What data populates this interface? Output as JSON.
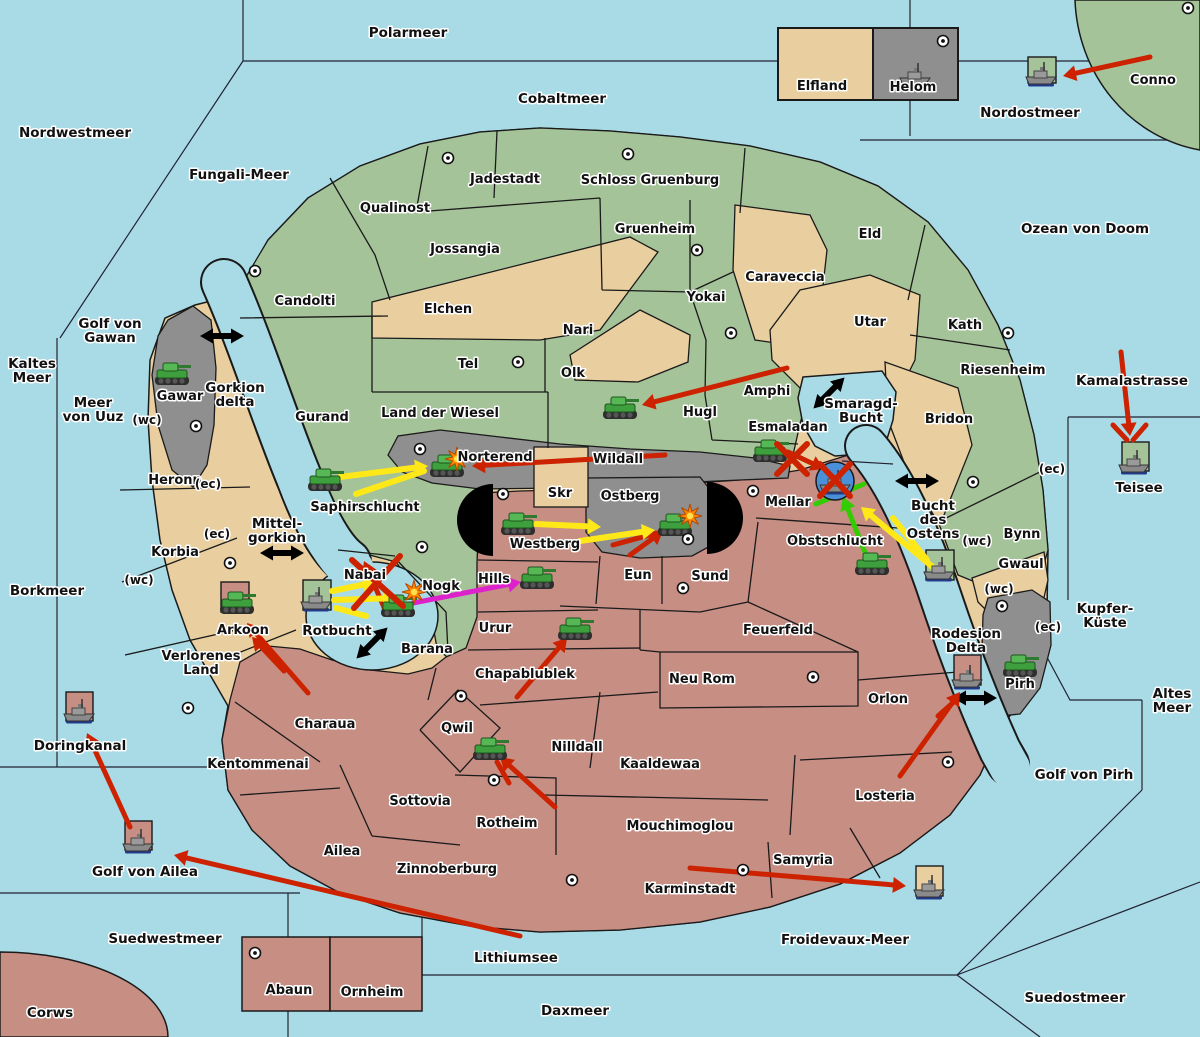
{
  "map_title": "Risk-style war map",
  "colors": {
    "sea": "#a9dbe7",
    "green_land": "#a5c398",
    "tan_land": "#e9cf9f",
    "salmon_land": "#c78e84",
    "gray_land": "#8f8f8f",
    "border": "#1a1a1a",
    "attack_red": "#cc2200",
    "attack_yellow": "#ffe818",
    "attack_green": "#33cc00",
    "attack_magenta": "#dd22cc",
    "naval_circle": "#4a90d9",
    "explosion": "#ff8800"
  },
  "sea_labels": [
    {
      "lines": [
        "Polarmeer"
      ],
      "x": 408,
      "y": 37
    },
    {
      "lines": [
        "Nordwestmeer"
      ],
      "x": 75,
      "y": 137
    },
    {
      "lines": [
        "Fungali-Meer"
      ],
      "x": 239,
      "y": 179
    },
    {
      "lines": [
        "Cobaltmeer"
      ],
      "x": 562,
      "y": 103
    },
    {
      "lines": [
        "Nordostmeer"
      ],
      "x": 1030,
      "y": 117
    },
    {
      "lines": [
        "Ozean von Doom"
      ],
      "x": 1085,
      "y": 233
    },
    {
      "lines": [
        "Kaltes",
        "Meer"
      ],
      "x": 32,
      "y": 368
    },
    {
      "lines": [
        "Golf von",
        "Gawan"
      ],
      "x": 110,
      "y": 328
    },
    {
      "lines": [
        "Meer",
        "von Uuz"
      ],
      "x": 93,
      "y": 407
    },
    {
      "lines": [
        "Gorkion",
        "delta"
      ],
      "x": 235,
      "y": 392
    },
    {
      "lines": [
        "Kamalastrasse"
      ],
      "x": 1132,
      "y": 385
    },
    {
      "lines": [
        "Mittel-",
        "gorkion"
      ],
      "x": 277,
      "y": 528
    },
    {
      "lines": [
        "Borkmeer"
      ],
      "x": 47,
      "y": 595
    },
    {
      "lines": [
        "Smaragd-",
        "Bucht"
      ],
      "x": 861,
      "y": 408
    },
    {
      "lines": [
        "Bucht",
        "des",
        "Ostens"
      ],
      "x": 933,
      "y": 510
    },
    {
      "lines": [
        "Teisee"
      ],
      "x": 1139,
      "y": 492
    },
    {
      "lines": [
        "Rotbucht"
      ],
      "x": 337,
      "y": 635
    },
    {
      "lines": [
        "Kupfer-",
        "Küste"
      ],
      "x": 1105,
      "y": 613
    },
    {
      "lines": [
        "Rodesion",
        "Delta"
      ],
      "x": 966,
      "y": 638
    },
    {
      "lines": [
        "Altes",
        "Meer"
      ],
      "x": 1172,
      "y": 698
    },
    {
      "lines": [
        "Golf von Pirh"
      ],
      "x": 1084,
      "y": 779
    },
    {
      "lines": [
        "Golf von Ailea"
      ],
      "x": 145,
      "y": 876
    },
    {
      "lines": [
        "Doringkanal"
      ],
      "x": 80,
      "y": 750
    },
    {
      "lines": [
        "Suedwestmeer"
      ],
      "x": 165,
      "y": 943
    },
    {
      "lines": [
        "Lithiumsee"
      ],
      "x": 516,
      "y": 962
    },
    {
      "lines": [
        "Daxmeer"
      ],
      "x": 575,
      "y": 1015
    },
    {
      "lines": [
        "Froidevaux-Meer"
      ],
      "x": 845,
      "y": 944
    },
    {
      "lines": [
        "Suedostmeer"
      ],
      "x": 1075,
      "y": 1002
    },
    {
      "lines": [
        "Corws"
      ],
      "x": 50,
      "y": 1017
    }
  ],
  "territory_labels": [
    {
      "lines": [
        "Qualinost"
      ],
      "x": 395,
      "y": 212
    },
    {
      "lines": [
        "Jadestadt"
      ],
      "x": 505,
      "y": 183
    },
    {
      "lines": [
        "Schloss Gruenburg"
      ],
      "x": 650,
      "y": 184
    },
    {
      "lines": [
        "Jossangia"
      ],
      "x": 465,
      "y": 253
    },
    {
      "lines": [
        "Candolti"
      ],
      "x": 305,
      "y": 305
    },
    {
      "lines": [
        "Gruenheim"
      ],
      "x": 655,
      "y": 233
    },
    {
      "lines": [
        "Elchen"
      ],
      "x": 448,
      "y": 313
    },
    {
      "lines": [
        "Nari"
      ],
      "x": 578,
      "y": 334
    },
    {
      "lines": [
        "Olk"
      ],
      "x": 573,
      "y": 377
    },
    {
      "lines": [
        "Tel"
      ],
      "x": 468,
      "y": 368
    },
    {
      "lines": [
        "Gurand"
      ],
      "x": 322,
      "y": 421
    },
    {
      "lines": [
        "Land der Wiesel"
      ],
      "x": 440,
      "y": 417
    },
    {
      "lines": [
        "Yokai"
      ],
      "x": 706,
      "y": 301
    },
    {
      "lines": [
        "Caraveccia"
      ],
      "x": 785,
      "y": 281
    },
    {
      "lines": [
        "Eld"
      ],
      "x": 870,
      "y": 238
    },
    {
      "lines": [
        "Utar"
      ],
      "x": 870,
      "y": 326
    },
    {
      "lines": [
        "Kath"
      ],
      "x": 965,
      "y": 329
    },
    {
      "lines": [
        "Riesenheim"
      ],
      "x": 1003,
      "y": 374
    },
    {
      "lines": [
        "Bridon"
      ],
      "x": 949,
      "y": 423
    },
    {
      "lines": [
        "Amphi"
      ],
      "x": 767,
      "y": 395
    },
    {
      "lines": [
        "Hugl"
      ],
      "x": 700,
      "y": 416
    },
    {
      "lines": [
        "Esmaladan"
      ],
      "x": 788,
      "y": 431
    },
    {
      "lines": [
        "Gawar"
      ],
      "x": 180,
      "y": 400
    },
    {
      "lines": [
        "Heronn"
      ],
      "x": 175,
      "y": 484
    },
    {
      "lines": [
        "Korbia"
      ],
      "x": 175,
      "y": 556
    },
    {
      "lines": [
        "Saphirschlucht"
      ],
      "x": 365,
      "y": 511
    },
    {
      "lines": [
        "Norterend"
      ],
      "x": 495,
      "y": 461
    },
    {
      "lines": [
        "Wildall"
      ],
      "x": 618,
      "y": 463
    },
    {
      "lines": [
        "Skr"
      ],
      "x": 560,
      "y": 497
    },
    {
      "lines": [
        "Ostberg"
      ],
      "x": 630,
      "y": 500
    },
    {
      "lines": [
        "Westberg"
      ],
      "x": 545,
      "y": 548
    },
    {
      "lines": [
        "Mellar"
      ],
      "x": 788,
      "y": 506
    },
    {
      "lines": [
        "Obstschlucht"
      ],
      "x": 835,
      "y": 545
    },
    {
      "lines": [
        "Eun"
      ],
      "x": 638,
      "y": 579
    },
    {
      "lines": [
        "Sund"
      ],
      "x": 710,
      "y": 580
    },
    {
      "lines": [
        "Hills"
      ],
      "x": 494,
      "y": 583
    },
    {
      "lines": [
        "Nabai"
      ],
      "x": 365,
      "y": 579
    },
    {
      "lines": [
        "Nogk"
      ],
      "x": 441,
      "y": 590
    },
    {
      "lines": [
        "Barana"
      ],
      "x": 427,
      "y": 653
    },
    {
      "lines": [
        "Urur"
      ],
      "x": 495,
      "y": 632
    },
    {
      "lines": [
        "Feuerfeld"
      ],
      "x": 778,
      "y": 634
    },
    {
      "lines": [
        "Neu Rom"
      ],
      "x": 702,
      "y": 683
    },
    {
      "lines": [
        "Chapablublek"
      ],
      "x": 525,
      "y": 678
    },
    {
      "lines": [
        "Qwil"
      ],
      "x": 457,
      "y": 732
    },
    {
      "lines": [
        "Nilldall"
      ],
      "x": 577,
      "y": 751
    },
    {
      "lines": [
        "Kaaldewaa"
      ],
      "x": 660,
      "y": 768
    },
    {
      "lines": [
        "Rotheim"
      ],
      "x": 507,
      "y": 827
    },
    {
      "lines": [
        "Mouchimoglou"
      ],
      "x": 680,
      "y": 830
    },
    {
      "lines": [
        "Sottovia"
      ],
      "x": 420,
      "y": 805
    },
    {
      "lines": [
        "Ailea"
      ],
      "x": 342,
      "y": 855
    },
    {
      "lines": [
        "Zinnoberburg"
      ],
      "x": 447,
      "y": 873
    },
    {
      "lines": [
        "Kentommenai"
      ],
      "x": 258,
      "y": 768
    },
    {
      "lines": [
        "Charaua"
      ],
      "x": 325,
      "y": 728
    },
    {
      "lines": [
        "Verlorenes",
        "Land"
      ],
      "x": 201,
      "y": 660
    },
    {
      "lines": [
        "Arkoon"
      ],
      "x": 243,
      "y": 634
    },
    {
      "lines": [
        "Karminstadt"
      ],
      "x": 690,
      "y": 893
    },
    {
      "lines": [
        "Samyria"
      ],
      "x": 803,
      "y": 864
    },
    {
      "lines": [
        "Orlon"
      ],
      "x": 888,
      "y": 703
    },
    {
      "lines": [
        "Losteria"
      ],
      "x": 885,
      "y": 800
    },
    {
      "lines": [
        "Bynn"
      ],
      "x": 1022,
      "y": 538
    },
    {
      "lines": [
        "Gwaul"
      ],
      "x": 1021,
      "y": 568
    },
    {
      "lines": [
        "Pirh"
      ],
      "x": 1020,
      "y": 688
    },
    {
      "lines": [
        "Elfland"
      ],
      "x": 822,
      "y": 90
    },
    {
      "lines": [
        "Helom"
      ],
      "x": 913,
      "y": 91
    },
    {
      "lines": [
        "Abaun"
      ],
      "x": 289,
      "y": 994
    },
    {
      "lines": [
        "Ornheim"
      ],
      "x": 372,
      "y": 996
    },
    {
      "lines": [
        "Conno"
      ],
      "x": 1153,
      "y": 84
    }
  ],
  "connector_labels": [
    {
      "text": "(wc)",
      "x": 147,
      "y": 424
    },
    {
      "text": "(ec)",
      "x": 208,
      "y": 488
    },
    {
      "text": "(ec)",
      "x": 217,
      "y": 538
    },
    {
      "text": "(wc)",
      "x": 139,
      "y": 584
    },
    {
      "text": "(wc)",
      "x": 977,
      "y": 545
    },
    {
      "text": "(ec)",
      "x": 1052,
      "y": 473
    },
    {
      "text": "(wc)",
      "x": 999,
      "y": 593
    },
    {
      "text": "(ec)",
      "x": 1048,
      "y": 631
    }
  ],
  "city_markers": [
    [
      255,
      271
    ],
    [
      448,
      158
    ],
    [
      628,
      154
    ],
    [
      697,
      250
    ],
    [
      731,
      333
    ],
    [
      518,
      362
    ],
    [
      196,
      426
    ],
    [
      943,
      41
    ],
    [
      1188,
      8
    ],
    [
      1008,
      333
    ],
    [
      973,
      482
    ],
    [
      420,
      449
    ],
    [
      422,
      547
    ],
    [
      503,
      494
    ],
    [
      688,
      539
    ],
    [
      753,
      491
    ],
    [
      683,
      588
    ],
    [
      230,
      563
    ],
    [
      188,
      708
    ],
    [
      461,
      696
    ],
    [
      494,
      780
    ],
    [
      813,
      677
    ],
    [
      572,
      880
    ],
    [
      743,
      870
    ],
    [
      948,
      762
    ],
    [
      1002,
      606
    ],
    [
      255,
      953
    ]
  ],
  "tanks": [
    [
      172,
      374
    ],
    [
      325,
      480
    ],
    [
      447,
      466
    ],
    [
      620,
      408
    ],
    [
      518,
      524
    ],
    [
      675,
      525
    ],
    [
      770,
      451
    ],
    [
      872,
      564
    ],
    [
      398,
      606
    ],
    [
      537,
      578
    ],
    [
      237,
      603
    ],
    [
      575,
      629
    ],
    [
      490,
      749
    ],
    [
      1020,
      666
    ]
  ],
  "ships": [
    {
      "x": 915,
      "y": 76
    },
    {
      "x": 1041,
      "y": 75
    },
    {
      "x": 1134,
      "y": 463
    },
    {
      "x": 939,
      "y": 570
    },
    {
      "x": 316,
      "y": 600
    },
    {
      "x": 79,
      "y": 712
    },
    {
      "x": 138,
      "y": 842
    },
    {
      "x": 929,
      "y": 888
    },
    {
      "x": 967,
      "y": 678
    },
    {
      "x": 835,
      "y": 483
    }
  ],
  "unit_boxes": [
    {
      "x": 1028,
      "y": 57,
      "w": 28,
      "h": 26,
      "fill": "green_land"
    },
    {
      "x": 1122,
      "y": 442,
      "w": 27,
      "h": 29,
      "fill": "green_land"
    },
    {
      "x": 926,
      "y": 550,
      "w": 28,
      "h": 30,
      "fill": "green_land"
    },
    {
      "x": 303,
      "y": 580,
      "w": 28,
      "h": 30,
      "fill": "green_land"
    },
    {
      "x": 221,
      "y": 582,
      "w": 28,
      "h": 30,
      "fill": "salmon_land"
    },
    {
      "x": 66,
      "y": 692,
      "w": 27,
      "h": 29,
      "fill": "salmon_land"
    },
    {
      "x": 125,
      "y": 821,
      "w": 27,
      "h": 29,
      "fill": "salmon_land"
    },
    {
      "x": 916,
      "y": 866,
      "w": 27,
      "h": 30,
      "fill": "tan_land"
    },
    {
      "x": 954,
      "y": 655,
      "w": 27,
      "h": 30,
      "fill": "salmon_land"
    }
  ],
  "naval_circle": {
    "x": 835,
    "y": 481,
    "r": 19
  },
  "explosions": [
    [
      457,
      459
    ],
    [
      690,
      516
    ],
    [
      414,
      592
    ]
  ],
  "red_x_marks": [
    [
      777,
      444,
      807,
      474
    ],
    [
      807,
      444,
      777,
      474
    ],
    [
      820,
      464,
      850,
      496
    ],
    [
      850,
      464,
      820,
      496
    ],
    [
      352,
      560,
      403,
      606
    ],
    [
      400,
      556,
      354,
      608
    ]
  ],
  "attack_arrows": [
    {
      "c": "red",
      "x1": 1150,
      "y1": 57,
      "x2": 1063,
      "y2": 76,
      "head": true
    },
    {
      "c": "red",
      "x1": 665,
      "y1": 455,
      "x2": 472,
      "y2": 466,
      "head": true
    },
    {
      "c": "red",
      "x1": 787,
      "y1": 368,
      "x2": 642,
      "y2": 405,
      "head": true
    },
    {
      "c": "red",
      "x1": 788,
      "y1": 452,
      "x2": 824,
      "y2": 469,
      "head": true
    },
    {
      "c": "red",
      "x1": 1121,
      "y1": 352,
      "x2": 1130,
      "y2": 436,
      "head": true
    },
    {
      "c": "red",
      "x1": 1113,
      "y1": 425,
      "x2": 1127,
      "y2": 440,
      "head": false
    },
    {
      "c": "red",
      "x1": 1146,
      "y1": 425,
      "x2": 1133,
      "y2": 440,
      "head": false
    },
    {
      "c": "red",
      "x1": 308,
      "y1": 693,
      "x2": 247,
      "y2": 623,
      "head": true
    },
    {
      "c": "red",
      "x1": 284,
      "y1": 671,
      "x2": 252,
      "y2": 637,
      "head": true
    },
    {
      "c": "red",
      "x1": 517,
      "y1": 697,
      "x2": 567,
      "y2": 638,
      "head": true
    },
    {
      "c": "red",
      "x1": 555,
      "y1": 807,
      "x2": 500,
      "y2": 757,
      "head": true
    },
    {
      "c": "red",
      "x1": 509,
      "y1": 783,
      "x2": 497,
      "y2": 762,
      "head": false
    },
    {
      "c": "red",
      "x1": 690,
      "y1": 868,
      "x2": 906,
      "y2": 886,
      "head": true
    },
    {
      "c": "red",
      "x1": 520,
      "y1": 936,
      "x2": 174,
      "y2": 855,
      "head": true
    },
    {
      "c": "red",
      "x1": 900,
      "y1": 776,
      "x2": 960,
      "y2": 692,
      "head": true
    },
    {
      "c": "red",
      "x1": 938,
      "y1": 716,
      "x2": 956,
      "y2": 700,
      "head": false
    },
    {
      "c": "red",
      "x1": 130,
      "y1": 827,
      "x2": 87,
      "y2": 733,
      "head": true
    },
    {
      "c": "red",
      "x1": 386,
      "y1": 612,
      "x2": 364,
      "y2": 561,
      "head": true
    },
    {
      "c": "red",
      "x1": 630,
      "y1": 555,
      "x2": 663,
      "y2": 531,
      "head": true
    },
    {
      "c": "red",
      "x1": 613,
      "y1": 545,
      "x2": 657,
      "y2": 533,
      "head": false
    },
    {
      "c": "yellow",
      "x1": 340,
      "y1": 477,
      "x2": 428,
      "y2": 466,
      "head": true
    },
    {
      "c": "yellow",
      "x1": 356,
      "y1": 494,
      "x2": 424,
      "y2": 471,
      "head": false
    },
    {
      "c": "yellow",
      "x1": 536,
      "y1": 524,
      "x2": 601,
      "y2": 527,
      "head": true
    },
    {
      "c": "yellow",
      "x1": 580,
      "y1": 541,
      "x2": 655,
      "y2": 530,
      "head": true
    },
    {
      "c": "yellow",
      "x1": 332,
      "y1": 591,
      "x2": 376,
      "y2": 582,
      "head": true
    },
    {
      "c": "yellow",
      "x1": 334,
      "y1": 600,
      "x2": 396,
      "y2": 598,
      "head": true
    },
    {
      "c": "yellow",
      "x1": 336,
      "y1": 608,
      "x2": 366,
      "y2": 616,
      "head": false
    },
    {
      "c": "yellow",
      "x1": 935,
      "y1": 569,
      "x2": 861,
      "y2": 507,
      "head": true
    },
    {
      "c": "yellow",
      "x1": 927,
      "y1": 560,
      "x2": 893,
      "y2": 518,
      "head": false
    },
    {
      "c": "green",
      "x1": 868,
      "y1": 560,
      "x2": 843,
      "y2": 497,
      "head": true
    },
    {
      "c": "green",
      "x1": 816,
      "y1": 504,
      "x2": 864,
      "y2": 484,
      "head": false
    },
    {
      "c": "magenta",
      "x1": 413,
      "y1": 603,
      "x2": 521,
      "y2": 582,
      "head": true
    }
  ],
  "transport_arrows": [
    {
      "x": 222,
      "y": 336,
      "angle": 0
    },
    {
      "x": 829,
      "y": 393,
      "angle": -45
    },
    {
      "x": 282,
      "y": 553,
      "angle": 0
    },
    {
      "x": 372,
      "y": 643,
      "angle": -45
    },
    {
      "x": 917,
      "y": 481,
      "angle": 0
    },
    {
      "x": 975,
      "y": 698,
      "angle": 0
    }
  ]
}
